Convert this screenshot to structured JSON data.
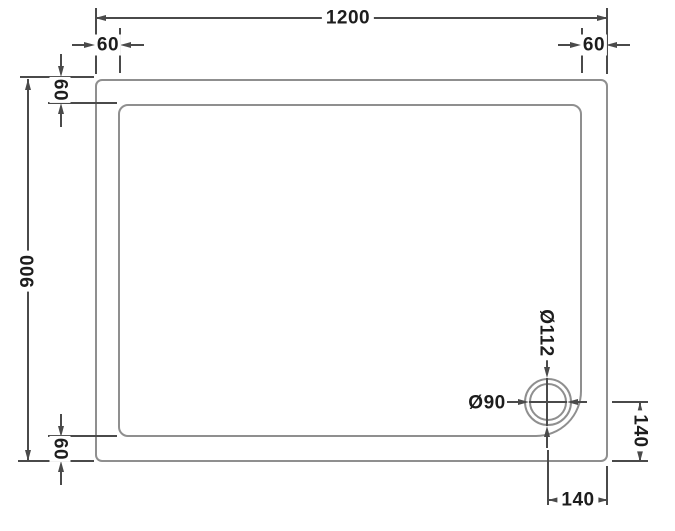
{
  "drawing": {
    "subject": "rectangular-shower-tray-plan-view",
    "dims": {
      "overall_width": "1200",
      "overall_depth": "900",
      "offset_top_left": "60",
      "offset_top_right": "60",
      "rim_top": "60",
      "rim_bottom": "60",
      "waste_outer_diameter": "Ø112",
      "waste_inner_diameter": "Ø90",
      "waste_offset_right": "140",
      "waste_offset_bottom": "140"
    }
  },
  "colors": {
    "background": "#ffffff",
    "tray_line": "#8f8f8f",
    "dimension_line": "#4a4a4a",
    "label_text": "#1d1d1d"
  }
}
